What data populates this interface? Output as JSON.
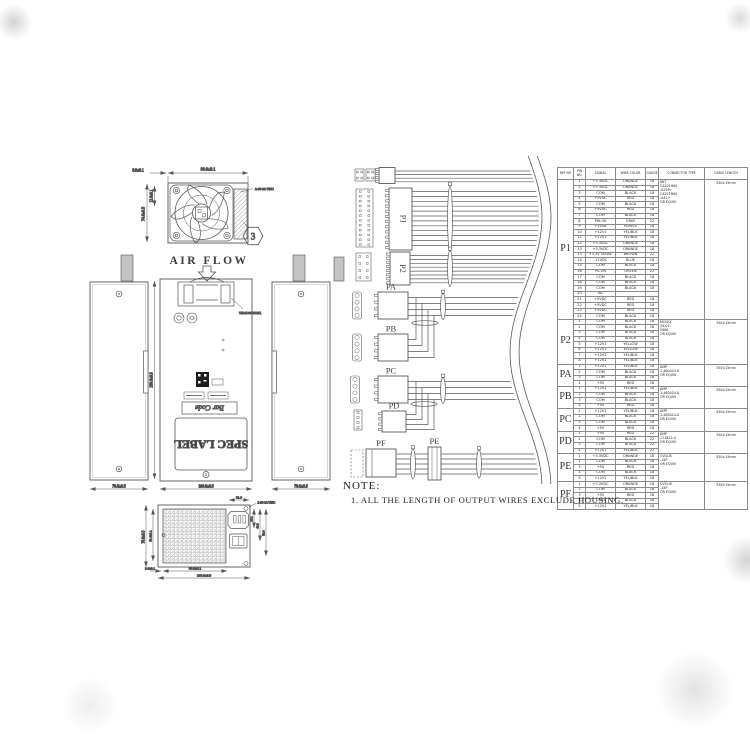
{
  "colors": {
    "paper": "#ffffff",
    "ink": "#4b4b4b",
    "ink_light": "#8a8a8a"
  },
  "fan_view": {
    "dim_offset": "6.0±0.1",
    "dim_width": "80.0±0.1",
    "dim_height": "74.0±0.5",
    "dim_inner": "12.0±0.1",
    "screw_note": "2-#6-32 UNC",
    "balloon": "3"
  },
  "airflow_label": "AIR FLOW",
  "side_views": {
    "dim_left": "70.0±0.5",
    "dim_center": "100.0±0.5",
    "dim_right": "70.0±0.5",
    "dim_length": "190.0±0.5",
    "strain_label": "TBT3P6SCF4N1",
    "spec_label": "SPEC LABEL",
    "barcode_label": "Bar Code"
  },
  "rear_view": {
    "dim_top": "31.9",
    "screw_note": "2-#6-32 UNC",
    "dim_h": "70.0±0.5",
    "dim_h2": "51.6±0.1",
    "dim_r1": "18.1",
    "dim_r2": "43.9",
    "dim_r3": "52.0",
    "dim_b1": "8.0±0.1",
    "dim_b2": "86.0±0.1",
    "dim_b3": "100.0±0.5"
  },
  "harness": {
    "labels": {
      "p1": "P1",
      "p2": "P2",
      "pa": "PA",
      "pb": "PB",
      "pc": "PC",
      "pd": "PD",
      "pe": "PE",
      "pf": "PF"
    }
  },
  "note": {
    "label": "NOTE:",
    "text": "1. ALL THE LENGTH OF OUTPUT WIRES EXCLUDE HOUSING."
  },
  "pin_table": {
    "headers": [
      "REF NO",
      "PIN NO.",
      "SIGNAL",
      "WIRE COLOR",
      "GAUGE",
      "CONNECTOR TYPE",
      "CABLE LENGTH"
    ],
    "groups": [
      {
        "ref": "P1",
        "connector": [
          "JWT",
          "C4201H00",
          "-A24P+",
          "C4201H00",
          "-A42+",
          "OR EQUIV"
        ],
        "length": "350±15mm",
        "pins": [
          [
            "1",
            "+3.3VDC",
            "ORANGE",
            "18"
          ],
          [
            "2",
            "+3.3VDC",
            "ORANGE",
            "18"
          ],
          [
            "3",
            "COM",
            "BLACK",
            "18"
          ],
          [
            "4",
            "+5VDC",
            "RED",
            "18"
          ],
          [
            "5",
            "COM",
            "BLACK",
            "18"
          ],
          [
            "6",
            "+5VDC",
            "RED",
            "18"
          ],
          [
            "7",
            "COM",
            "BLACK",
            "18"
          ],
          [
            "8",
            "PW-OK",
            "GRAY",
            "22"
          ],
          [
            "9",
            "+5VSB",
            "PURPLE",
            "18"
          ],
          [
            "10",
            "+12V1",
            "YEL/BLK",
            "18"
          ],
          [
            "11",
            "+12V1",
            "YEL/BLK",
            "18"
          ],
          [
            "12",
            "+3.3VDC",
            "ORANGE",
            "18"
          ],
          [
            "13",
            "+3.3VDC",
            "ORANGE",
            "18"
          ],
          [
            "13",
            "+3.3V SENSE",
            "BROWN",
            "22"
          ],
          [
            "14",
            "-12VDC",
            "BLUE",
            "18"
          ],
          [
            "15",
            "COM",
            "BLACK",
            "18"
          ],
          [
            "16",
            "PS-ON",
            "GREEN",
            "22"
          ],
          [
            "17",
            "COM",
            "BLACK",
            "18"
          ],
          [
            "18",
            "COM",
            "BLACK",
            "18"
          ],
          [
            "19",
            "COM",
            "BLACK",
            "18"
          ],
          [
            "20",
            "NC",
            "",
            ""
          ],
          [
            "21",
            "+5VDC",
            "RED",
            "18"
          ],
          [
            "22",
            "+5VDC",
            "RED",
            "18"
          ],
          [
            "23",
            "+5VDC",
            "RED",
            "18"
          ],
          [
            "24",
            "COM",
            "BLACK",
            "18"
          ]
        ]
      },
      {
        "ref": "P2",
        "connector": [
          "MOLEX",
          "39-01-",
          "2080",
          "OR EQUIV"
        ],
        "length": "350±15mm",
        "pins": [
          [
            "1",
            "COM",
            "BLACK",
            "18"
          ],
          [
            "2",
            "COM",
            "BLACK",
            "18"
          ],
          [
            "3",
            "COM",
            "BLACK",
            "18"
          ],
          [
            "4",
            "COM",
            "BLACK",
            "18"
          ],
          [
            "5",
            "+12V1",
            "YELLOW",
            "18"
          ],
          [
            "6",
            "+12V1",
            "YELLOW",
            "18"
          ],
          [
            "7",
            "+12V1",
            "YEL/BLK",
            "18"
          ],
          [
            "8",
            "+12V1",
            "YEL/BLK",
            "18"
          ]
        ]
      },
      {
        "ref": "PA",
        "connector": [
          "AMP",
          "1-480424-0",
          "OR EQUIV"
        ],
        "length": "350±15mm",
        "pins": [
          [
            "1",
            "+12V1",
            "YEL/BLK",
            "18"
          ],
          [
            "2",
            "COM",
            "BLACK",
            "18"
          ],
          [
            "3",
            "COM",
            "BLACK",
            "18"
          ],
          [
            "4",
            "+5V",
            "RED",
            "18"
          ]
        ]
      },
      {
        "ref": "PB",
        "connector": [
          "AMP",
          "1-480424-0",
          "OR EQUIV"
        ],
        "length": "350±15mm",
        "pins": [
          [
            "1",
            "+12V1",
            "YEL/BLK",
            "18"
          ],
          [
            "2",
            "COM",
            "BLACK",
            "18"
          ],
          [
            "3",
            "COM",
            "BLACK",
            "18"
          ],
          [
            "4",
            "+5V",
            "RED",
            "18"
          ]
        ]
      },
      {
        "ref": "PC",
        "connector": [
          "AMP",
          "1-480424-0",
          "OR EQUIV"
        ],
        "length": "350±15mm",
        "pins": [
          [
            "1",
            "+12V1",
            "YEL/BLK",
            "18"
          ],
          [
            "2",
            "COM",
            "BLACK",
            "18"
          ],
          [
            "3",
            "COM",
            "BLACK",
            "18"
          ],
          [
            "4",
            "+5V",
            "RED",
            "18"
          ]
        ]
      },
      {
        "ref": "PD",
        "connector": [
          "AMP",
          "171822-4",
          "OR EQUIV"
        ],
        "length": "350±15mm",
        "pins": [
          [
            "1",
            "+5V",
            "RED",
            "22"
          ],
          [
            "2",
            "COM",
            "BLACK",
            "22"
          ],
          [
            "3",
            "COM",
            "BLACK",
            "22"
          ],
          [
            "4",
            "+12V1",
            "YEL/BLK",
            "22"
          ]
        ]
      },
      {
        "ref": "PE",
        "connector": [
          "CVILUX",
          "-15P",
          "OR EQUIV"
        ],
        "length": "350±15mm",
        "pins": [
          [
            "1",
            "+3.3VDC",
            "ORANGE",
            "18"
          ],
          [
            "2",
            "COM",
            "BLACK",
            "18"
          ],
          [
            "3",
            "+5V",
            "RED",
            "18"
          ],
          [
            "4",
            "COM",
            "BLACK",
            "18"
          ],
          [
            "5",
            "+12V1",
            "YEL/BLK",
            "18"
          ]
        ]
      },
      {
        "ref": "PF",
        "connector": [
          "CVILUX",
          "-15P",
          "OR EQUIV"
        ],
        "length": "350±15mm",
        "pins": [
          [
            "1",
            "+3.3VDC",
            "ORANGE",
            "18"
          ],
          [
            "2",
            "COM",
            "BLACK",
            "18"
          ],
          [
            "3",
            "+5V",
            "RED",
            "18"
          ],
          [
            "4",
            "COM",
            "BLACK",
            "18"
          ],
          [
            "5",
            "+12V1",
            "YEL/BLK",
            "18"
          ]
        ]
      }
    ]
  }
}
